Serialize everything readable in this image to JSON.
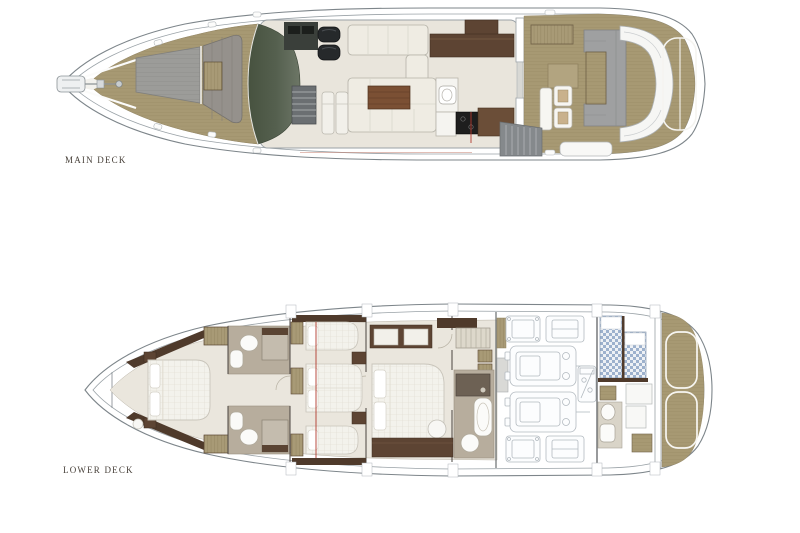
{
  "decks": [
    {
      "id": "main-deck",
      "label": "MAIN DECK"
    },
    {
      "id": "lower-deck",
      "label": "LOWER DECK"
    }
  ],
  "colors": {
    "background": "#ffffff",
    "teak": "#a79973",
    "teak_line": "#8e8059",
    "hull_outline": "#7d858a",
    "interior_floor": "#e9e5dc",
    "dark_wood": "#5d4433",
    "accent_wood": "#4f3a2b",
    "glass_dark": "#47523f",
    "upholstery_gray": "#9fa0a1",
    "upholstery_cream": "#efece3",
    "bathroom_floor": "#b7ad9d",
    "bed_quilt": "#f3f2ec",
    "crew_mattress_blue": "#8fa6c6",
    "section_line_red": "#b23a2e",
    "label_text": "#463f38"
  }
}
